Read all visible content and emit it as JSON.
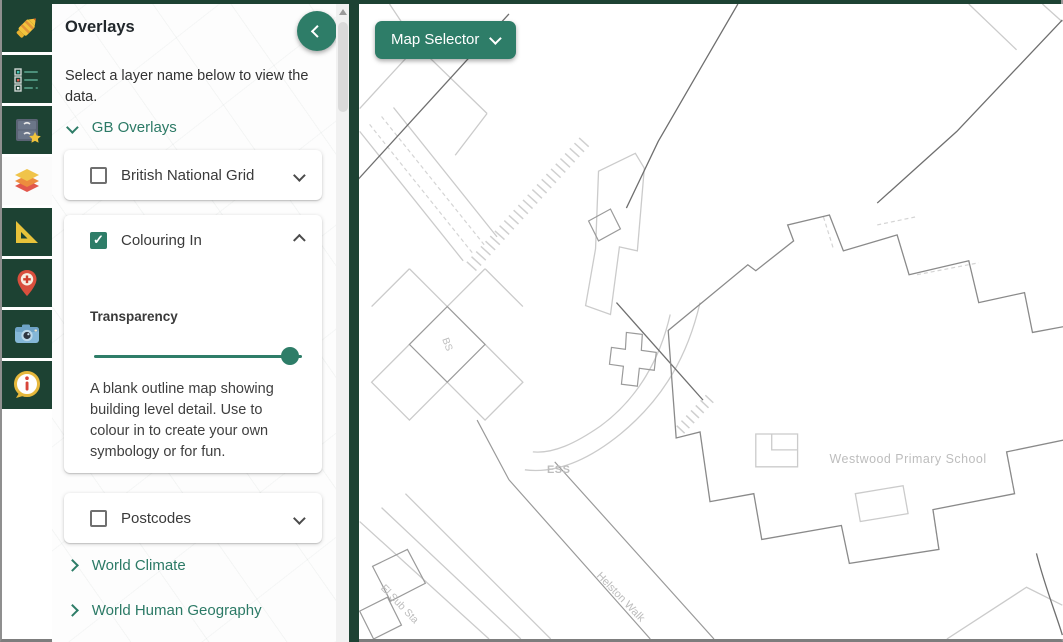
{
  "colors": {
    "brand_dark": "#1d4233",
    "accent": "#2e7d68",
    "link_teal": "#2c7a66"
  },
  "icon_strip": {
    "items": [
      {
        "name": "crayon-icon",
        "active": false
      },
      {
        "name": "legend-list-icon",
        "active": false
      },
      {
        "name": "saved-maps-icon",
        "active": false
      },
      {
        "name": "overlays-layers-icon",
        "active": true
      },
      {
        "name": "measure-set-square-icon",
        "active": false
      },
      {
        "name": "markers-pin-icon",
        "active": false
      },
      {
        "name": "camera-icon",
        "active": false
      },
      {
        "name": "info-icon",
        "active": false
      }
    ]
  },
  "sidebar": {
    "title": "Overlays",
    "description": "Select a layer name below to view the data.",
    "groups": [
      {
        "label": "GB Overlays",
        "state": "expanded"
      },
      {
        "label": "World Climate",
        "state": "collapsed"
      },
      {
        "label": "World Human Geography",
        "state": "collapsed"
      }
    ],
    "layers": [
      {
        "label": "British National Grid",
        "checked": false,
        "expanded": false
      },
      {
        "label": "Colouring In",
        "checked": true,
        "expanded": true,
        "transparency_label": "Transparency",
        "transparency_percent": 94,
        "check_glyph": "✓",
        "description": "A blank outline map showing building level detail. Use to colour in to create your own symbology or for fun."
      },
      {
        "label": "Postcodes",
        "checked": false,
        "expanded": false
      }
    ]
  },
  "map": {
    "selector_label": "Map Selector",
    "labels": {
      "school": "Westwood Primary School",
      "ess": "ESS",
      "walk": "Helston Walk",
      "substation": "El Sub Sta",
      "bs": "BS"
    }
  }
}
